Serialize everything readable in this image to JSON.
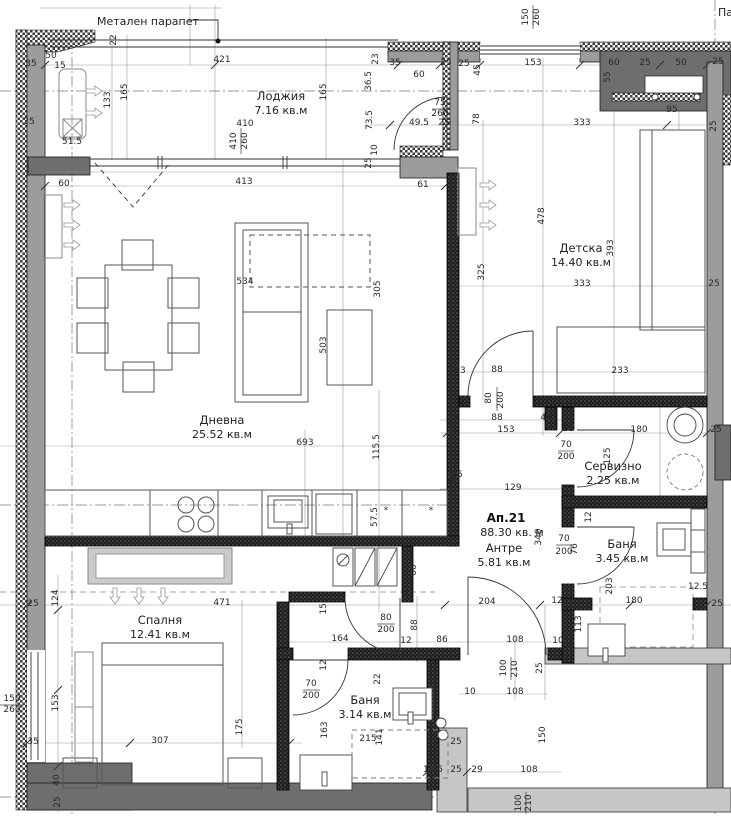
{
  "drawing": {
    "parapet_label": "Метален парапет",
    "edge_label": "Па",
    "apartment": {
      "name": "Ап.21",
      "area": "88.30 кв. м"
    },
    "rooms": [
      {
        "name": "Лоджия",
        "area": "7.16 кв.м",
        "x": 281,
        "y": 100
      },
      {
        "name": "Дневна",
        "area": "25.52 кв.м",
        "x": 222,
        "y": 424
      },
      {
        "name": "Детска",
        "area": "14.40 кв.м",
        "x": 581,
        "y": 252
      },
      {
        "name": "Сервизно",
        "area": "2.25 кв.м",
        "x": 613,
        "y": 470
      },
      {
        "name": "Баня",
        "area": "3.45 кв.м",
        "x": 622,
        "y": 548
      },
      {
        "name": "Антре",
        "area": "5.81 кв.м",
        "x": 504,
        "y": 552
      },
      {
        "name": "Спалня",
        "area": "12.41 кв.м",
        "x": 160,
        "y": 624
      },
      {
        "name": "Баня",
        "area": "3.14 кв.м",
        "x": 365,
        "y": 704
      }
    ],
    "dimensions": [
      {
        "t": "22",
        "x": 116,
        "y": 40,
        "r": -90
      },
      {
        "t": "421",
        "x": 222,
        "y": 62
      },
      {
        "t": "35",
        "x": 31,
        "y": 66
      },
      {
        "t": "50",
        "x": 51,
        "y": 58
      },
      {
        "t": "15",
        "x": 60,
        "y": 68
      },
      {
        "t": "165",
        "x": 127,
        "y": 92,
        "r": -90
      },
      {
        "t": "133",
        "x": 110,
        "y": 100,
        "r": -90
      },
      {
        "t": "25",
        "x": 29,
        "y": 124
      },
      {
        "t": "51.5",
        "x": 72,
        "y": 144
      },
      {
        "t": "410",
        "x": 245,
        "y": 126
      },
      {
        "t": "410",
        "x": 236,
        "y": 141,
        "r": -90
      },
      {
        "t": "260",
        "x": 247,
        "y": 141,
        "r": -90
      },
      {
        "t": "165",
        "x": 326,
        "y": 92,
        "r": -90
      },
      {
        "t": "60",
        "x": 64,
        "y": 186
      },
      {
        "t": "413",
        "x": 244,
        "y": 184
      },
      {
        "t": "61",
        "x": 423,
        "y": 187
      },
      {
        "t": "150",
        "x": 528,
        "y": 17,
        "r": -90
      },
      {
        "t": "260",
        "x": 539,
        "y": 17,
        "r": -90
      },
      {
        "t": "23",
        "x": 378,
        "y": 59,
        "r": -90
      },
      {
        "t": "35",
        "x": 395,
        "y": 65
      },
      {
        "t": "36.5",
        "x": 371,
        "y": 81,
        "r": -90
      },
      {
        "t": "60",
        "x": 419,
        "y": 77
      },
      {
        "t": "25",
        "x": 446,
        "y": 65
      },
      {
        "t": "25",
        "x": 464,
        "y": 66
      },
      {
        "t": "45",
        "x": 480,
        "y": 70,
        "r": -90
      },
      {
        "t": "153",
        "x": 533,
        "y": 65
      },
      {
        "t": "60",
        "x": 614,
        "y": 65
      },
      {
        "t": "55",
        "x": 610,
        "y": 77,
        "r": -90
      },
      {
        "t": "25",
        "x": 645,
        "y": 65
      },
      {
        "t": "50",
        "x": 681,
        "y": 65
      },
      {
        "t": "25",
        "x": 718,
        "y": 64
      },
      {
        "t": "75",
        "x": 440,
        "y": 105
      },
      {
        "t": "260",
        "x": 440,
        "y": 116
      },
      {
        "t": "73.5",
        "x": 372,
        "y": 120,
        "r": -90
      },
      {
        "t": "49.5",
        "x": 419,
        "y": 125
      },
      {
        "t": "25",
        "x": 444,
        "y": 125
      },
      {
        "t": "78",
        "x": 479,
        "y": 119,
        "r": -90
      },
      {
        "t": "333",
        "x": 582,
        "y": 125
      },
      {
        "t": "95",
        "x": 672,
        "y": 112
      },
      {
        "t": "25",
        "x": 716,
        "y": 126,
        "r": -90
      },
      {
        "t": "10",
        "x": 377,
        "y": 150,
        "r": -90
      },
      {
        "t": "25",
        "x": 371,
        "y": 163,
        "r": -90
      },
      {
        "t": "478",
        "x": 544,
        "y": 216,
        "r": -90
      },
      {
        "t": "393",
        "x": 613,
        "y": 248,
        "r": -90
      },
      {
        "t": "325",
        "x": 484,
        "y": 272,
        "r": -90
      },
      {
        "t": "333",
        "x": 582,
        "y": 286
      },
      {
        "t": "25",
        "x": 714,
        "y": 286
      },
      {
        "t": "13",
        "x": 460,
        "y": 373
      },
      {
        "t": "88",
        "x": 497,
        "y": 372
      },
      {
        "t": "233",
        "x": 620,
        "y": 373
      },
      {
        "t": "80",
        "x": 491,
        "y": 398,
        "r": -90
      },
      {
        "t": "200",
        "x": 503,
        "y": 400,
        "r": -90
      },
      {
        "t": "24",
        "x": 453,
        "y": 420
      },
      {
        "t": "88",
        "x": 497,
        "y": 420
      },
      {
        "t": "41",
        "x": 546,
        "y": 420
      },
      {
        "t": "153",
        "x": 506,
        "y": 432
      },
      {
        "t": "12",
        "x": 568,
        "y": 431
      },
      {
        "t": "180",
        "x": 639,
        "y": 432
      },
      {
        "t": "25",
        "x": 716,
        "y": 432
      },
      {
        "t": "70",
        "x": 566,
        "y": 447
      },
      {
        "t": "200",
        "x": 566,
        "y": 459
      },
      {
        "t": "125",
        "x": 610,
        "y": 456,
        "r": -90
      },
      {
        "t": "25",
        "x": 452,
        "y": 481
      },
      {
        "t": "129",
        "x": 513,
        "y": 490
      },
      {
        "t": "12",
        "x": 591,
        "y": 517,
        "r": -90
      },
      {
        "t": "340",
        "x": 541,
        "y": 537,
        "r": -90
      },
      {
        "t": "70",
        "x": 564,
        "y": 541
      },
      {
        "t": "200",
        "x": 564,
        "y": 554
      },
      {
        "t": "76",
        "x": 577,
        "y": 549,
        "r": -90
      },
      {
        "t": "203",
        "x": 612,
        "y": 586,
        "r": -90
      },
      {
        "t": "180",
        "x": 634,
        "y": 603
      },
      {
        "t": "12.5",
        "x": 698,
        "y": 589
      },
      {
        "t": "25",
        "x": 717,
        "y": 606
      },
      {
        "t": "12",
        "x": 557,
        "y": 603
      },
      {
        "t": "204",
        "x": 487,
        "y": 604
      },
      {
        "t": "113",
        "x": 581,
        "y": 624,
        "r": -90
      },
      {
        "t": "108",
        "x": 515,
        "y": 642
      },
      {
        "t": "10",
        "x": 558,
        "y": 643
      },
      {
        "t": "100",
        "x": 506,
        "y": 668,
        "r": -90
      },
      {
        "t": "210",
        "x": 517,
        "y": 669,
        "r": -90
      },
      {
        "t": "25",
        "x": 542,
        "y": 668,
        "r": -90
      },
      {
        "t": "10",
        "x": 470,
        "y": 694
      },
      {
        "t": "108",
        "x": 515,
        "y": 694
      },
      {
        "t": "150",
        "x": 545,
        "y": 735,
        "r": -90
      },
      {
        "t": "12.5",
        "x": 433,
        "y": 772
      },
      {
        "t": "25",
        "x": 456,
        "y": 772
      },
      {
        "t": "29",
        "x": 477,
        "y": 772
      },
      {
        "t": "108",
        "x": 529,
        "y": 772
      },
      {
        "t": "100",
        "x": 521,
        "y": 803,
        "r": -90
      },
      {
        "t": "210",
        "x": 531,
        "y": 803,
        "r": -90
      },
      {
        "t": "124",
        "x": 58,
        "y": 598,
        "r": -90
      },
      {
        "t": "25",
        "x": 33,
        "y": 606
      },
      {
        "t": "471",
        "x": 222,
        "y": 605
      },
      {
        "t": "150",
        "x": 12,
        "y": 701
      },
      {
        "t": "260",
        "x": 12,
        "y": 712
      },
      {
        "t": "153",
        "x": 58,
        "y": 703,
        "r": -90
      },
      {
        "t": "35",
        "x": 33,
        "y": 744
      },
      {
        "t": "307",
        "x": 160,
        "y": 743
      },
      {
        "t": "175",
        "x": 242,
        "y": 727,
        "r": -90
      },
      {
        "t": "40",
        "x": 59,
        "y": 780,
        "r": -90
      },
      {
        "t": "25",
        "x": 60,
        "y": 802,
        "r": -90
      },
      {
        "t": "152",
        "x": 326,
        "y": 606,
        "r": -90
      },
      {
        "t": "80",
        "x": 386,
        "y": 620
      },
      {
        "t": "200",
        "x": 386,
        "y": 632
      },
      {
        "t": "88",
        "x": 417,
        "y": 625,
        "r": -90
      },
      {
        "t": "164",
        "x": 340,
        "y": 641
      },
      {
        "t": "12",
        "x": 406,
        "y": 643
      },
      {
        "t": "86",
        "x": 442,
        "y": 642
      },
      {
        "t": "12",
        "x": 326,
        "y": 665,
        "r": -90
      },
      {
        "t": "22",
        "x": 380,
        "y": 679,
        "r": -90
      },
      {
        "t": "70",
        "x": 311,
        "y": 686
      },
      {
        "t": "200",
        "x": 311,
        "y": 698
      },
      {
        "t": "163",
        "x": 327,
        "y": 730,
        "r": -90
      },
      {
        "t": "215",
        "x": 368,
        "y": 741
      },
      {
        "t": "141",
        "x": 382,
        "y": 737,
        "r": -90
      },
      {
        "t": "25",
        "x": 456,
        "y": 744
      },
      {
        "t": "60",
        "x": 416,
        "y": 570,
        "r": -90
      },
      {
        "t": "57.5",
        "x": 377,
        "y": 517,
        "r": -90
      },
      {
        "t": "25",
        "x": 457,
        "y": 477
      },
      {
        "t": "693",
        "x": 305,
        "y": 445
      },
      {
        "t": "115.5",
        "x": 379,
        "y": 447,
        "r": -90
      },
      {
        "t": "534",
        "x": 245,
        "y": 284
      },
      {
        "t": "305",
        "x": 380,
        "y": 289,
        "r": -90
      },
      {
        "t": "503",
        "x": 326,
        "y": 345,
        "r": -90
      },
      {
        "t": "*",
        "x": 386,
        "y": 513
      },
      {
        "t": "*",
        "x": 431,
        "y": 513
      }
    ]
  }
}
